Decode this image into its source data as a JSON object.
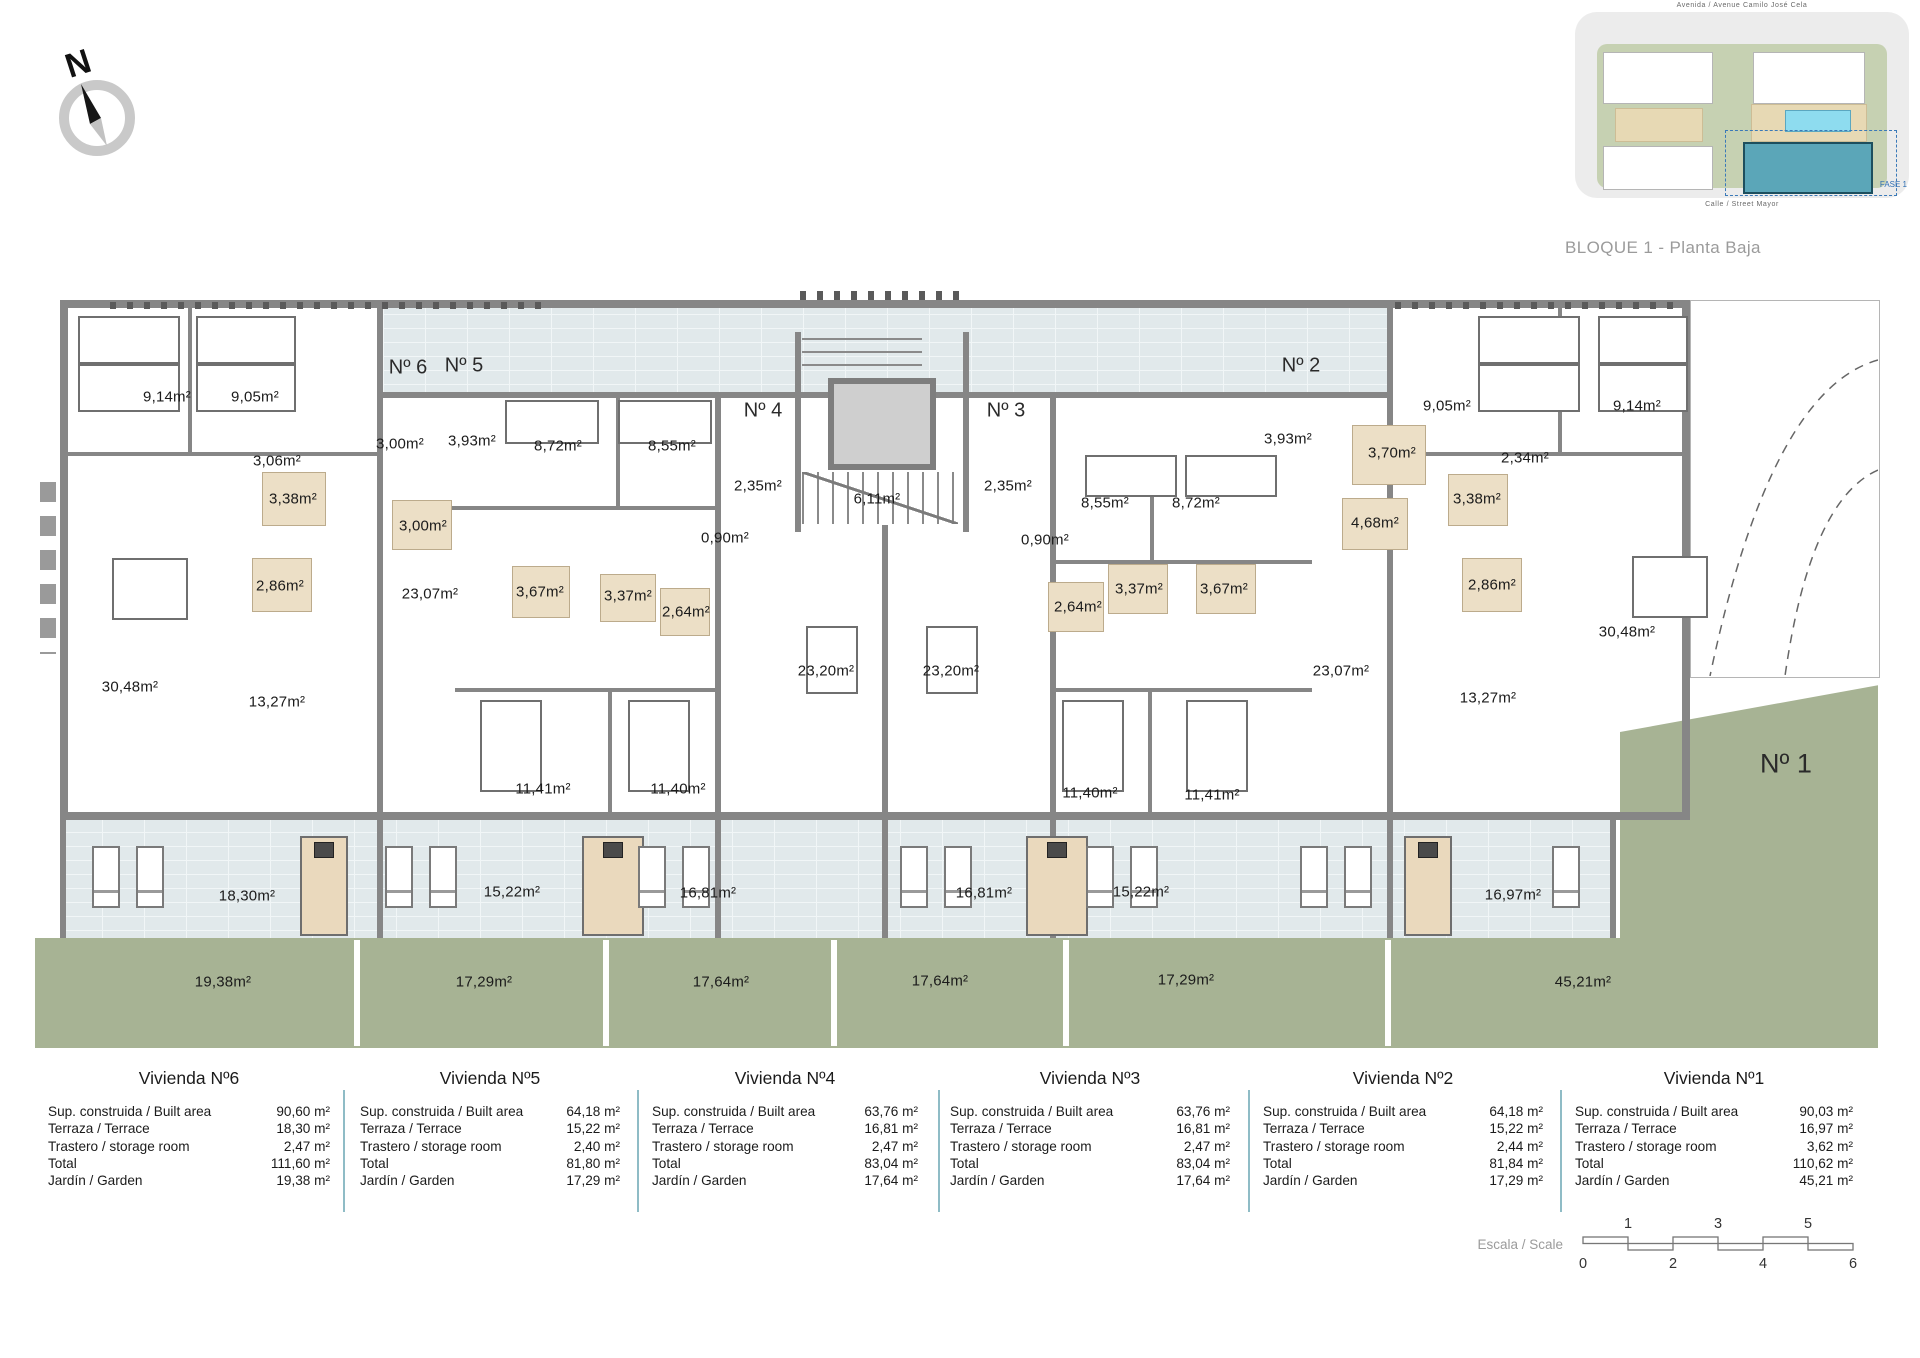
{
  "title": "BLOQUE 1 - Planta Baja",
  "compass": {
    "label": "N"
  },
  "inset": {
    "street_top": "Avenida / Avenue Camilo José Cela",
    "street_bottom": "Calle / Street Mayor",
    "phase": "FASE 1"
  },
  "plan": {
    "units": [
      {
        "label": "Nº 6",
        "x": 408,
        "y": 368,
        "size": 20
      },
      {
        "label": "Nº 5",
        "x": 464,
        "y": 366,
        "size": 20
      },
      {
        "label": "Nº 4",
        "x": 763,
        "y": 411,
        "size": 20
      },
      {
        "label": "Nº 3",
        "x": 1006,
        "y": 411,
        "size": 20
      },
      {
        "label": "Nº 2",
        "x": 1301,
        "y": 366,
        "size": 20
      },
      {
        "label": "Nº 1",
        "x": 1786,
        "y": 764,
        "size": 27
      }
    ],
    "labels": [
      {
        "x": 167,
        "y": 397,
        "t": "9,14m²"
      },
      {
        "x": 255,
        "y": 397,
        "t": "9,05m²"
      },
      {
        "x": 277,
        "y": 461,
        "t": "3,06m²"
      },
      {
        "x": 400,
        "y": 444,
        "t": "3,00m²"
      },
      {
        "x": 293,
        "y": 499,
        "t": "3,38m²"
      },
      {
        "x": 423,
        "y": 526,
        "t": "3,00m²"
      },
      {
        "x": 280,
        "y": 586,
        "t": "2,86m²"
      },
      {
        "x": 430,
        "y": 594,
        "t": "23,07m²"
      },
      {
        "x": 130,
        "y": 687,
        "t": "30,48m²"
      },
      {
        "x": 277,
        "y": 702,
        "t": "13,27m²"
      },
      {
        "x": 472,
        "y": 441,
        "t": "3,93m²"
      },
      {
        "x": 558,
        "y": 446,
        "t": "8,72m²"
      },
      {
        "x": 672,
        "y": 446,
        "t": "8,55m²"
      },
      {
        "x": 540,
        "y": 592,
        "t": "3,67m²"
      },
      {
        "x": 628,
        "y": 596,
        "t": "3,37m²"
      },
      {
        "x": 686,
        "y": 612,
        "t": "2,64m²"
      },
      {
        "x": 543,
        "y": 789,
        "t": "11,41m²"
      },
      {
        "x": 678,
        "y": 789,
        "t": "11,40m²"
      },
      {
        "x": 758,
        "y": 486,
        "t": "2,35m²"
      },
      {
        "x": 725,
        "y": 538,
        "t": "0,90m²"
      },
      {
        "x": 877,
        "y": 499,
        "t": "6,11m²"
      },
      {
        "x": 826,
        "y": 671,
        "t": "23,20m²"
      },
      {
        "x": 1008,
        "y": 486,
        "t": "2,35m²"
      },
      {
        "x": 1045,
        "y": 540,
        "t": "0,90m²"
      },
      {
        "x": 1105,
        "y": 503,
        "t": "8,55m²"
      },
      {
        "x": 1196,
        "y": 503,
        "t": "8,72m²"
      },
      {
        "x": 951,
        "y": 671,
        "t": "23,20m²"
      },
      {
        "x": 1078,
        "y": 607,
        "t": "2,64m²"
      },
      {
        "x": 1139,
        "y": 589,
        "t": "3,37m²"
      },
      {
        "x": 1224,
        "y": 589,
        "t": "3,67m²"
      },
      {
        "x": 1090,
        "y": 793,
        "t": "11,40m²"
      },
      {
        "x": 1212,
        "y": 795,
        "t": "11,41m²"
      },
      {
        "x": 1288,
        "y": 439,
        "t": "3,93m²"
      },
      {
        "x": 1392,
        "y": 453,
        "t": "3,70m²"
      },
      {
        "x": 1447,
        "y": 406,
        "t": "9,05m²"
      },
      {
        "x": 1525,
        "y": 458,
        "t": "2,34m²"
      },
      {
        "x": 1637,
        "y": 406,
        "t": "9,14m²"
      },
      {
        "x": 1375,
        "y": 523,
        "t": "4,68m²"
      },
      {
        "x": 1477,
        "y": 499,
        "t": "3,38m²"
      },
      {
        "x": 1492,
        "y": 585,
        "t": "2,86m²"
      },
      {
        "x": 1341,
        "y": 671,
        "t": "23,07m²"
      },
      {
        "x": 1488,
        "y": 698,
        "t": "13,27m²"
      },
      {
        "x": 1627,
        "y": 632,
        "t": "30,48m²"
      },
      {
        "x": 247,
        "y": 896,
        "t": "18,30m²"
      },
      {
        "x": 512,
        "y": 892,
        "t": "15,22m²"
      },
      {
        "x": 708,
        "y": 893,
        "t": "16,81m²"
      },
      {
        "x": 984,
        "y": 893,
        "t": "16,81m²"
      },
      {
        "x": 1141,
        "y": 892,
        "t": "15,22m²"
      },
      {
        "x": 1513,
        "y": 895,
        "t": "16,97m²"
      },
      {
        "x": 223,
        "y": 982,
        "t": "19,38m²"
      },
      {
        "x": 484,
        "y": 982,
        "t": "17,29m²"
      },
      {
        "x": 721,
        "y": 982,
        "t": "17,64m²"
      },
      {
        "x": 940,
        "y": 981,
        "t": "17,64m²"
      },
      {
        "x": 1186,
        "y": 980,
        "t": "17,29m²"
      },
      {
        "x": 1583,
        "y": 982,
        "t": "45,21m²"
      }
    ]
  },
  "tables": {
    "row_labels": [
      "Sup. construida / Built area",
      "Terraza / Terrace",
      "Trastero / storage room",
      "Total",
      "Jardín / Garden"
    ],
    "items": [
      {
        "title": "Vivienda Nº6",
        "values": [
          "90,60 m²",
          "18,30 m²",
          "2,47 m²",
          "111,60 m²",
          "19,38 m²"
        ]
      },
      {
        "title": "Vivienda Nº5",
        "values": [
          "64,18 m²",
          "15,22 m²",
          "2,40 m²",
          "81,80 m²",
          "17,29 m²"
        ]
      },
      {
        "title": "Vivienda Nº4",
        "values": [
          "63,76 m²",
          "16,81 m²",
          "2,47 m²",
          "83,04 m²",
          "17,64 m²"
        ]
      },
      {
        "title": "Vivienda Nº3",
        "values": [
          "63,76 m²",
          "16,81 m²",
          "2,47 m²",
          "83,04 m²",
          "17,64 m²"
        ]
      },
      {
        "title": "Vivienda Nº2",
        "values": [
          "64,18 m²",
          "15,22 m²",
          "2,44 m²",
          "81,84 m²",
          "17,29 m²"
        ]
      },
      {
        "title": "Vivienda Nº1",
        "values": [
          "90,03 m²",
          "16,97 m²",
          "3,62 m²",
          "110,62 m²",
          "45,21 m²"
        ]
      }
    ]
  },
  "scale": {
    "label": "Escala / Scale",
    "top_ticks": [
      "1",
      "3",
      "5"
    ],
    "bottom_ticks": [
      "0",
      "2",
      "4",
      "6"
    ]
  },
  "colors": {
    "wall": "#868686",
    "terrace": "#e1e9eb",
    "garden": "#a7b394",
    "bath": "#ecdfc6",
    "table_divider": "#8fbcc6",
    "highlight_building": "#5ba6b8"
  }
}
